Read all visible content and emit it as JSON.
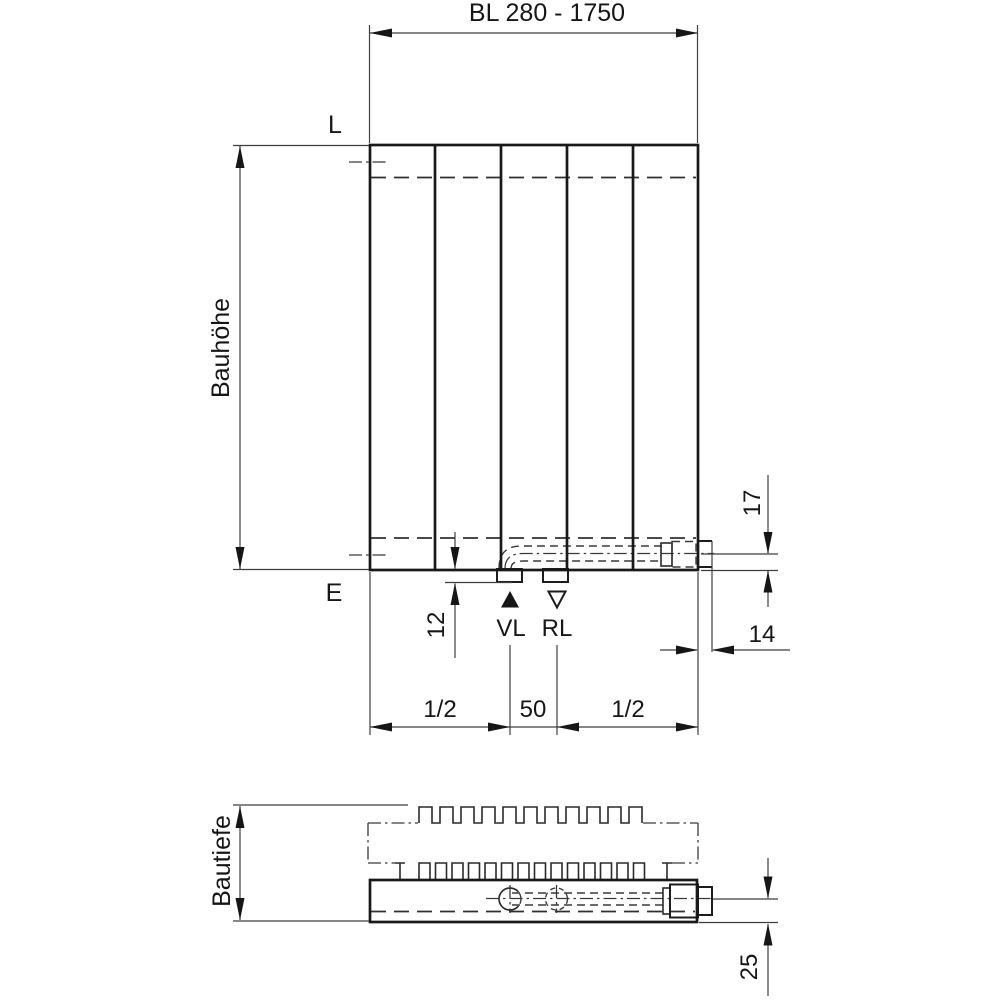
{
  "drawing": {
    "background_color": "#ffffff",
    "line_color": "#1a1a1a",
    "labels": {
      "top_connection_line": "L",
      "bottom_connection_line": "E",
      "supply": "VL",
      "return": "RL",
      "height": "Bauhöhe",
      "depth": "Bautiefe"
    },
    "dimensions": {
      "length_range": "BL 280 - 1750",
      "tab_drop": "12",
      "pipe_axis_from_bottom": "17",
      "stub_projection": "14",
      "left_span": "1/2",
      "center_span": "50",
      "right_span": "1/2",
      "pipe_axis_depth": "25"
    }
  }
}
